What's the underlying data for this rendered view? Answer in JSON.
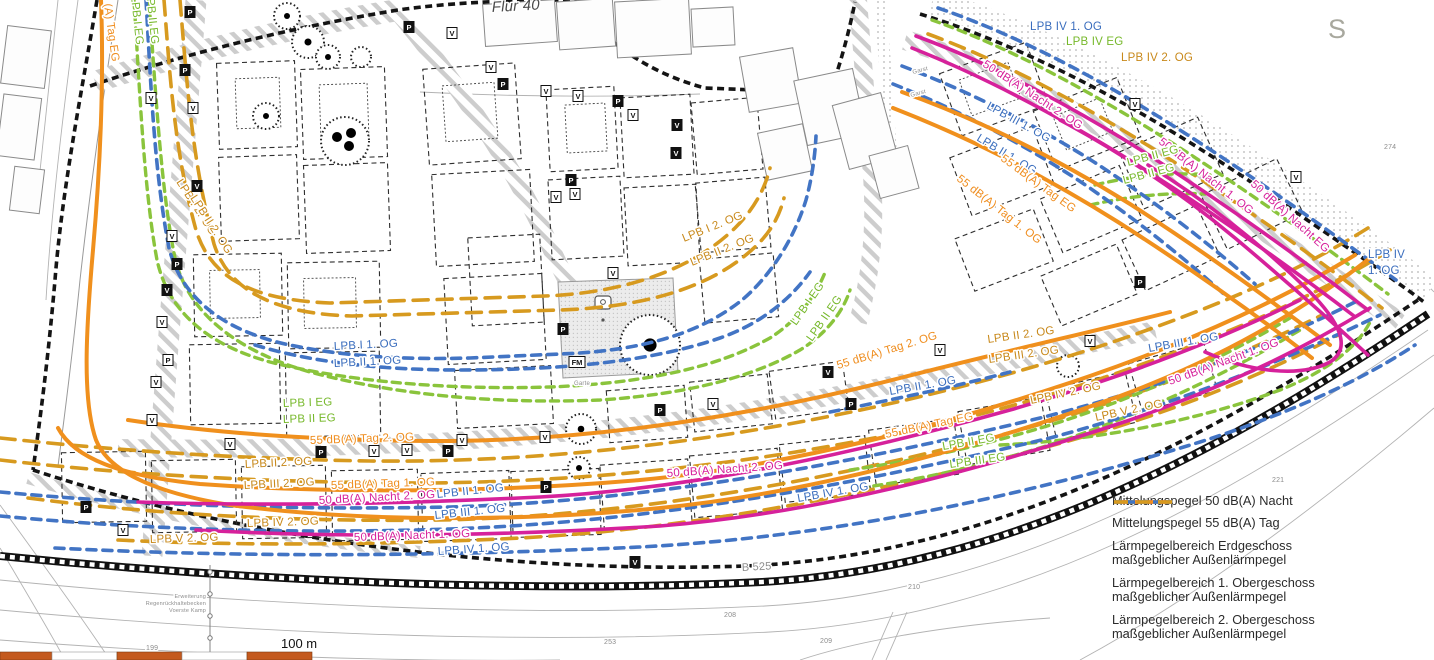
{
  "colors": {
    "magenta": "#d6219b",
    "orange": "#f0901d",
    "green": "#8ac43c",
    "blue": "#4274c4",
    "mustard": "#d79a1f",
    "scalebar": "#c45a1e"
  },
  "legend": {
    "items": [
      {
        "key": "nacht50",
        "label": "Mittelungspegel 50 dB(A) Nacht",
        "label2": "",
        "style": "solid",
        "color": "#d6219b"
      },
      {
        "key": "tag55",
        "label": "Mittelungspegel 55 dB(A) Tag",
        "label2": "",
        "style": "solid",
        "color": "#f0901d"
      },
      {
        "key": "lpb-eg",
        "label": "Lärmpegelbereich Erdgeschoss",
        "label2": "maßgeblicher Außenlärmpegel",
        "style": "dashed",
        "color": "#8ac43c"
      },
      {
        "key": "lpb-1og",
        "label": "Lärmpegelbereich 1. Obergeschoss",
        "label2": "maßgeblicher Außenlärmpegel",
        "style": "dashed",
        "color": "#4274c4"
      },
      {
        "key": "lpb-2og",
        "label": "Lärmpegelbereich 2. Obergeschoss",
        "label2": "maßgeblicher Außenlärmpegel",
        "style": "dashed-long",
        "color": "#d79a1f"
      }
    ]
  },
  "scale": {
    "label": "100 m"
  },
  "map": {
    "labels": [
      {
        "t": "(A) Tag EG",
        "x": 104,
        "y": 4,
        "rot": 82,
        "c": "o"
      },
      {
        "t": "LPB I EG",
        "x": 131,
        "y": -4,
        "rot": 84,
        "c": "g"
      },
      {
        "t": "LPB II EG",
        "x": 146,
        "y": -8,
        "rot": 84,
        "c": "g"
      },
      {
        "t": "LPB I 2. OG",
        "x": 176,
        "y": 182,
        "rot": 57,
        "c": "m"
      },
      {
        "t": "LPB II 2. OG",
        "x": 190,
        "y": 198,
        "rot": 57,
        "c": "m"
      },
      {
        "t": "LPB I 1. OG",
        "x": 334,
        "y": 350,
        "rot": -3,
        "c": "b"
      },
      {
        "t": "LPB II 1. OG",
        "x": 334,
        "y": 367,
        "rot": -3,
        "c": "b"
      },
      {
        "t": "LPB I EG",
        "x": 283,
        "y": 407,
        "rot": -2,
        "c": "g"
      },
      {
        "t": "LPB II EG",
        "x": 283,
        "y": 423,
        "rot": -2,
        "c": "g"
      },
      {
        "t": "55 dB(A) Tag 2. OG",
        "x": 310,
        "y": 444,
        "rot": -2,
        "c": "o"
      },
      {
        "t": "LPB II 2. OG",
        "x": 245,
        "y": 468,
        "rot": -3,
        "c": "m"
      },
      {
        "t": "LPB III 2. OG",
        "x": 244,
        "y": 489,
        "rot": -3,
        "c": "m"
      },
      {
        "t": "55 dB(A) Tag 1. OG",
        "x": 331,
        "y": 489,
        "rot": -2,
        "c": "o"
      },
      {
        "t": "50 dB(A) Nacht 2. OG",
        "x": 319,
        "y": 504,
        "rot": -3,
        "c": "p"
      },
      {
        "t": "LPB II 1. OG",
        "x": 437,
        "y": 498,
        "rot": -6,
        "c": "b"
      },
      {
        "t": "LPB III 1. OG",
        "x": 435,
        "y": 519,
        "rot": -6,
        "c": "b"
      },
      {
        "t": "LPB IV 2. OG",
        "x": 247,
        "y": 527,
        "rot": -2,
        "c": "m"
      },
      {
        "t": "50 dB(A) Nacht 1. OG",
        "x": 354,
        "y": 541,
        "rot": -2,
        "c": "p"
      },
      {
        "t": "LPB IV 1. OG",
        "x": 438,
        "y": 555,
        "rot": -4,
        "c": "b"
      },
      {
        "t": "LPB V 2. OG",
        "x": 150,
        "y": 543,
        "rot": -2,
        "c": "m"
      },
      {
        "t": "LPB I 2. OG",
        "x": 684,
        "y": 242,
        "rot": -22,
        "c": "m"
      },
      {
        "t": "LPB II 2. OG",
        "x": 692,
        "y": 266,
        "rot": -22,
        "c": "m"
      },
      {
        "t": "LPB I EG",
        "x": 796,
        "y": 326,
        "rot": -55,
        "c": "g"
      },
      {
        "t": "LPB II EG",
        "x": 812,
        "y": 342,
        "rot": -55,
        "c": "g"
      },
      {
        "t": "55 dB(A) Tag 2. OG",
        "x": 838,
        "y": 369,
        "rot": -17,
        "c": "o"
      },
      {
        "t": "LPB II 1. OG",
        "x": 890,
        "y": 395,
        "rot": -10,
        "c": "b"
      },
      {
        "t": "55 dB(A) Tag EG",
        "x": 886,
        "y": 438,
        "rot": -12,
        "c": "o"
      },
      {
        "t": "LPB II EG",
        "x": 943,
        "y": 450,
        "rot": -10,
        "c": "g"
      },
      {
        "t": "LPB III EG",
        "x": 950,
        "y": 468,
        "rot": -8,
        "c": "g"
      },
      {
        "t": "50 dB(A) Nacht 2. OG",
        "x": 667,
        "y": 477,
        "rot": -4,
        "c": "p"
      },
      {
        "t": "LPB IV 1. OG",
        "x": 798,
        "y": 502,
        "rot": -10,
        "c": "b"
      },
      {
        "t": "LPB II 2. OG",
        "x": 988,
        "y": 343,
        "rot": -8,
        "c": "m"
      },
      {
        "t": "LPB III 2. OG",
        "x": 989,
        "y": 363,
        "rot": -8,
        "c": "m"
      },
      {
        "t": "LPB III 1. OG",
        "x": 1149,
        "y": 352,
        "rot": -10,
        "c": "b"
      },
      {
        "t": "50 dB(A) Nacht 1. OG",
        "x": 1170,
        "y": 385,
        "rot": -20,
        "c": "p"
      },
      {
        "t": "LPB IV 2. OG",
        "x": 1031,
        "y": 404,
        "rot": -12,
        "c": "m"
      },
      {
        "t": "LPB V 2. OG",
        "x": 1096,
        "y": 421,
        "rot": -12,
        "c": "m"
      },
      {
        "t": "LPB IV 1. OG",
        "x": 1030,
        "y": 30,
        "rot": 0,
        "c": "b"
      },
      {
        "t": "LPB IV EG",
        "x": 1066,
        "y": 45,
        "rot": 0,
        "c": "g"
      },
      {
        "t": "LPB IV 2. OG",
        "x": 1121,
        "y": 61,
        "rot": 0,
        "c": "m"
      },
      {
        "t": "50 dB(A) Nacht 2. OG",
        "x": 982,
        "y": 66,
        "rot": 33,
        "c": "p"
      },
      {
        "t": "LPB III 1. OG",
        "x": 986,
        "y": 108,
        "rot": 29,
        "c": "b"
      },
      {
        "t": "LPB II 1. OG",
        "x": 976,
        "y": 140,
        "rot": 31,
        "c": "b"
      },
      {
        "t": "55 dB(A) Tag EG",
        "x": 1000,
        "y": 160,
        "rot": 36,
        "c": "o"
      },
      {
        "t": "55 dB(A) Tag 1. OG",
        "x": 956,
        "y": 180,
        "rot": 38,
        "c": "o"
      },
      {
        "t": "50 dB(A) Nacht 1. OG",
        "x": 1158,
        "y": 143,
        "rot": 38,
        "c": "p"
      },
      {
        "t": "50 dB(A) Nacht EG",
        "x": 1250,
        "y": 185,
        "rot": 42,
        "c": "p"
      },
      {
        "t": "LPB II EG",
        "x": 1128,
        "y": 166,
        "rot": -15,
        "c": "g"
      },
      {
        "t": "LPB II EG",
        "x": 1124,
        "y": 184,
        "rot": -15,
        "c": "g"
      },
      {
        "t": "LPB IV",
        "x": 1368,
        "y": 258,
        "rot": 0,
        "c": "b"
      },
      {
        "t": "1. OG",
        "x": 1368,
        "y": 274,
        "rot": 0,
        "c": "b"
      },
      {
        "t": "Flur 40",
        "x": 492,
        "y": 12,
        "rot": -3,
        "c": "i",
        "fs": 15,
        "n": "district-label"
      },
      {
        "t": "B 525",
        "x": 742,
        "y": 571,
        "rot": -3,
        "c": "k",
        "fs": 11,
        "n": "road-label"
      },
      {
        "t": "S",
        "x": 1328,
        "y": 38,
        "rot": 0,
        "c": "k2",
        "fs": 27,
        "n": "street-letter"
      },
      {
        "t": "221",
        "x": 1272,
        "y": 482,
        "rot": 0,
        "c": "k",
        "fs": 7,
        "n": "parcel-number"
      },
      {
        "t": "208",
        "x": 724,
        "y": 617,
        "rot": 0,
        "c": "k",
        "fs": 7,
        "n": "parcel-number"
      },
      {
        "t": "209",
        "x": 820,
        "y": 643,
        "rot": 0,
        "c": "k",
        "fs": 7,
        "n": "parcel-number"
      },
      {
        "t": "210",
        "x": 908,
        "y": 589,
        "rot": 0,
        "c": "k",
        "fs": 7,
        "n": "parcel-number"
      },
      {
        "t": "253",
        "x": 604,
        "y": 644,
        "rot": 0,
        "c": "k",
        "fs": 7,
        "n": "parcel-number"
      },
      {
        "t": "199",
        "x": 146,
        "y": 650,
        "rot": 0,
        "c": "k",
        "fs": 7,
        "n": "parcel-number"
      },
      {
        "t": "274",
        "x": 1384,
        "y": 149,
        "rot": 0,
        "c": "k",
        "fs": 7,
        "n": "parcel-number"
      },
      {
        "t": "Garst",
        "x": 913,
        "y": 74,
        "rot": -15,
        "c": "k",
        "fs": 6,
        "n": "garage-label"
      },
      {
        "t": "Garst",
        "x": 911,
        "y": 97,
        "rot": -15,
        "c": "k",
        "fs": 6,
        "n": "garage-label"
      },
      {
        "t": "Garte",
        "x": 574,
        "y": 385,
        "rot": 0,
        "c": "k",
        "fs": 6,
        "n": "garden-label"
      },
      {
        "t": "Erweiterung",
        "x": 206,
        "y": 598,
        "rot": 0,
        "c": "k",
        "fs": 5.5,
        "a": "e",
        "n": "annotation-line"
      },
      {
        "t": "Regenrückhaltebecken",
        "x": 206,
        "y": 605,
        "rot": 0,
        "c": "k",
        "fs": 5.5,
        "a": "e",
        "n": "annotation-line"
      },
      {
        "t": "Voerste Kamp",
        "x": 206,
        "y": 612,
        "rot": 0,
        "c": "k",
        "fs": 5.5,
        "a": "e",
        "n": "annotation-line"
      }
    ],
    "markers": [
      {
        "t": "P",
        "x": 190,
        "y": 12,
        "v": "d"
      },
      {
        "t": "V",
        "x": 151,
        "y": 98,
        "v": "l"
      },
      {
        "t": "P",
        "x": 185,
        "y": 70,
        "v": "d"
      },
      {
        "t": "V",
        "x": 193,
        "y": 108,
        "v": "l"
      },
      {
        "t": "V",
        "x": 197,
        "y": 186,
        "v": "d"
      },
      {
        "t": "V",
        "x": 172,
        "y": 236,
        "v": "l"
      },
      {
        "t": "P",
        "x": 177,
        "y": 264,
        "v": "d"
      },
      {
        "t": "V",
        "x": 167,
        "y": 290,
        "v": "d"
      },
      {
        "t": "V",
        "x": 162,
        "y": 322,
        "v": "l"
      },
      {
        "t": "P",
        "x": 168,
        "y": 360,
        "v": "l"
      },
      {
        "t": "V",
        "x": 156,
        "y": 382,
        "v": "l"
      },
      {
        "t": "V",
        "x": 152,
        "y": 420,
        "v": "l"
      },
      {
        "t": "V",
        "x": 230,
        "y": 444,
        "v": "l"
      },
      {
        "t": "P",
        "x": 321,
        "y": 452,
        "v": "d"
      },
      {
        "t": "V",
        "x": 374,
        "y": 451,
        "v": "l"
      },
      {
        "t": "V",
        "x": 407,
        "y": 450,
        "v": "l"
      },
      {
        "t": "P",
        "x": 448,
        "y": 451,
        "v": "d"
      },
      {
        "t": "V",
        "x": 462,
        "y": 440,
        "v": "l"
      },
      {
        "t": "V",
        "x": 545,
        "y": 437,
        "v": "l"
      },
      {
        "t": "P",
        "x": 563,
        "y": 329,
        "v": "d"
      },
      {
        "t": "FM",
        "x": 577,
        "y": 362,
        "v": "l"
      },
      {
        "t": "V",
        "x": 556,
        "y": 197,
        "v": "l"
      },
      {
        "t": "V",
        "x": 613,
        "y": 273,
        "v": "l"
      },
      {
        "t": "P",
        "x": 409,
        "y": 27,
        "v": "d"
      },
      {
        "t": "V",
        "x": 452,
        "y": 33,
        "v": "l"
      },
      {
        "t": "V",
        "x": 491,
        "y": 67,
        "v": "l"
      },
      {
        "t": "P",
        "x": 503,
        "y": 84,
        "v": "d"
      },
      {
        "t": "V",
        "x": 546,
        "y": 91,
        "v": "l"
      },
      {
        "t": "V",
        "x": 578,
        "y": 96,
        "v": "l"
      },
      {
        "t": "P",
        "x": 618,
        "y": 101,
        "v": "d"
      },
      {
        "t": "V",
        "x": 633,
        "y": 115,
        "v": "l"
      },
      {
        "t": "V",
        "x": 677,
        "y": 125,
        "v": "d"
      },
      {
        "t": "V",
        "x": 676,
        "y": 153,
        "v": "d"
      },
      {
        "t": "P",
        "x": 571,
        "y": 180,
        "v": "d"
      },
      {
        "t": "V",
        "x": 575,
        "y": 194,
        "v": "l"
      },
      {
        "t": "P",
        "x": 660,
        "y": 410,
        "v": "d"
      },
      {
        "t": "V",
        "x": 713,
        "y": 404,
        "v": "l"
      },
      {
        "t": "P",
        "x": 851,
        "y": 404,
        "v": "d"
      },
      {
        "t": "V",
        "x": 940,
        "y": 350,
        "v": "l"
      },
      {
        "t": "V",
        "x": 1090,
        "y": 341,
        "v": "l"
      },
      {
        "t": "P",
        "x": 1140,
        "y": 282,
        "v": "d"
      },
      {
        "t": "V",
        "x": 828,
        "y": 372,
        "v": "d"
      },
      {
        "t": "V",
        "x": 1135,
        "y": 104,
        "v": "l"
      },
      {
        "t": "P",
        "x": 546,
        "y": 487,
        "v": "d"
      },
      {
        "t": "V",
        "x": 635,
        "y": 562,
        "v": "d"
      },
      {
        "t": "V",
        "x": 123,
        "y": 530,
        "v": "l"
      },
      {
        "t": "P",
        "x": 86,
        "y": 507,
        "v": "d"
      },
      {
        "t": "V",
        "x": 1296,
        "y": 177,
        "v": "l"
      }
    ]
  }
}
